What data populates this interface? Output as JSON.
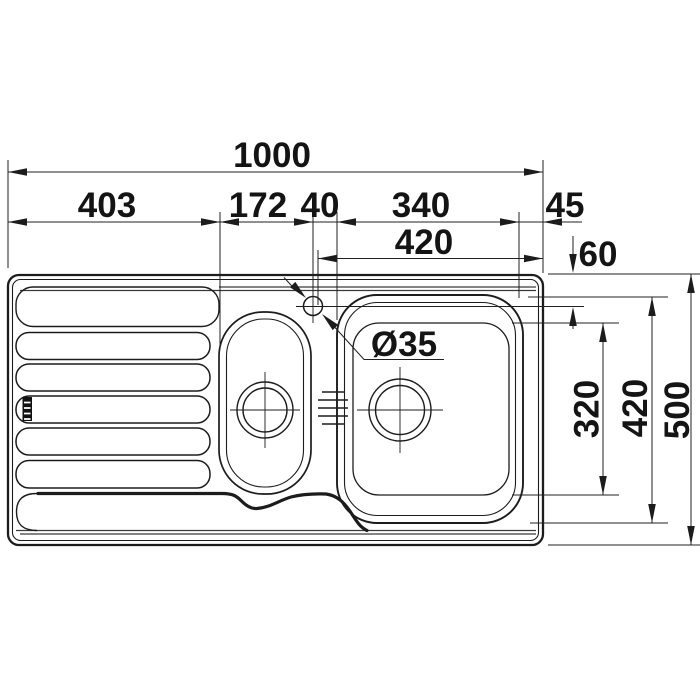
{
  "drawing": {
    "type": "kitchen-sink-top-view-technical-drawing",
    "dims": {
      "overall_width": "1000",
      "drainboard_width": "403",
      "drainboard_to_tap": "172",
      "tap_to_bowl": "40",
      "bowl_width": "340",
      "bowl_to_edge": "45",
      "bowl_zone_width": "420",
      "tap_center_from_back": "60",
      "tap_hole_diameter": "Ø35",
      "bowl_inner_depth": "320",
      "bowl_outer_depth": "420",
      "overall_depth": "500"
    },
    "colors": {
      "line": "#1c1c1c",
      "background": "#ffffff"
    }
  }
}
